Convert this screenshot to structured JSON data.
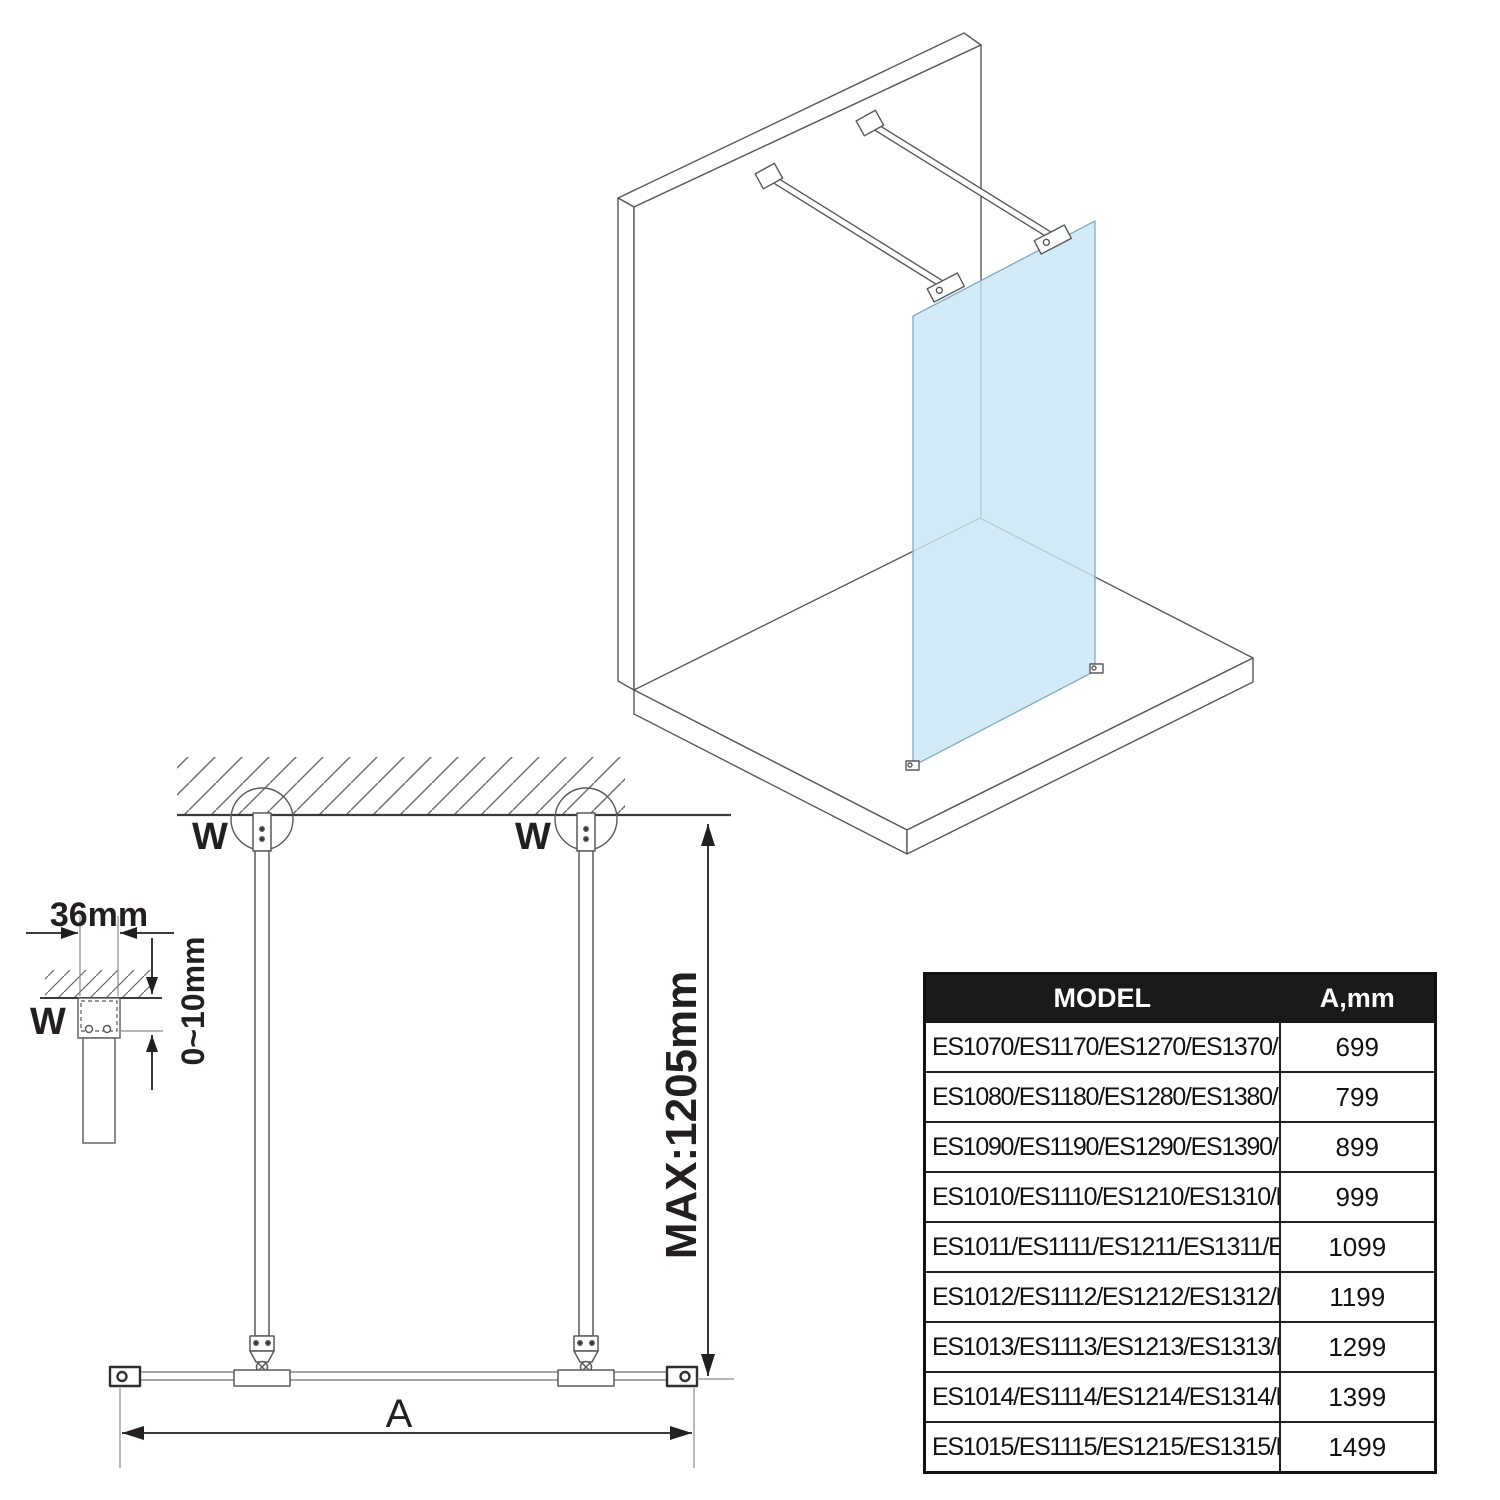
{
  "labels": {
    "bracket_width": "36mm",
    "bracket_gap": "0~10mm",
    "wall_marker_detail": "W",
    "wall_marker_left": "W",
    "wall_marker_right": "W",
    "max_bar_length": "MAX:1205mm",
    "glass_width": "A"
  },
  "table": {
    "header": {
      "model": "MODEL",
      "a_mm": "A,mm"
    },
    "rows": [
      {
        "model": "ES1070/ES1170/ES1270/ES1370/ES1570",
        "a_mm": "699"
      },
      {
        "model": "ES1080/ES1180/ES1280/ES1380/ES1580",
        "a_mm": "799"
      },
      {
        "model": "ES1090/ES1190/ES1290/ES1390/ES1590",
        "a_mm": "899"
      },
      {
        "model": "ES1010/ES1110/ES1210/ES1310/ES1510",
        "a_mm": "999"
      },
      {
        "model": "ES1011/ES1111/ES1211/ES1311/ES1511",
        "a_mm": "1099"
      },
      {
        "model": "ES1012/ES1112/ES1212/ES1312/ES1512",
        "a_mm": "1199"
      },
      {
        "model": "ES1013/ES1113/ES1213/ES1313/ES1513",
        "a_mm": "1299"
      },
      {
        "model": "ES1014/ES1114/ES1214/ES1314/ES1514",
        "a_mm": "1399"
      },
      {
        "model": "ES1015/ES1115/ES1215/ES1315/ES1515",
        "a_mm": "1499"
      }
    ]
  },
  "colors": {
    "glass": "#C9E7F8",
    "drawing_line": "#58595B",
    "dimension": "#231F20",
    "table_header_bg": "#1A1A1A",
    "table_header_text": "#FFFFFF"
  }
}
